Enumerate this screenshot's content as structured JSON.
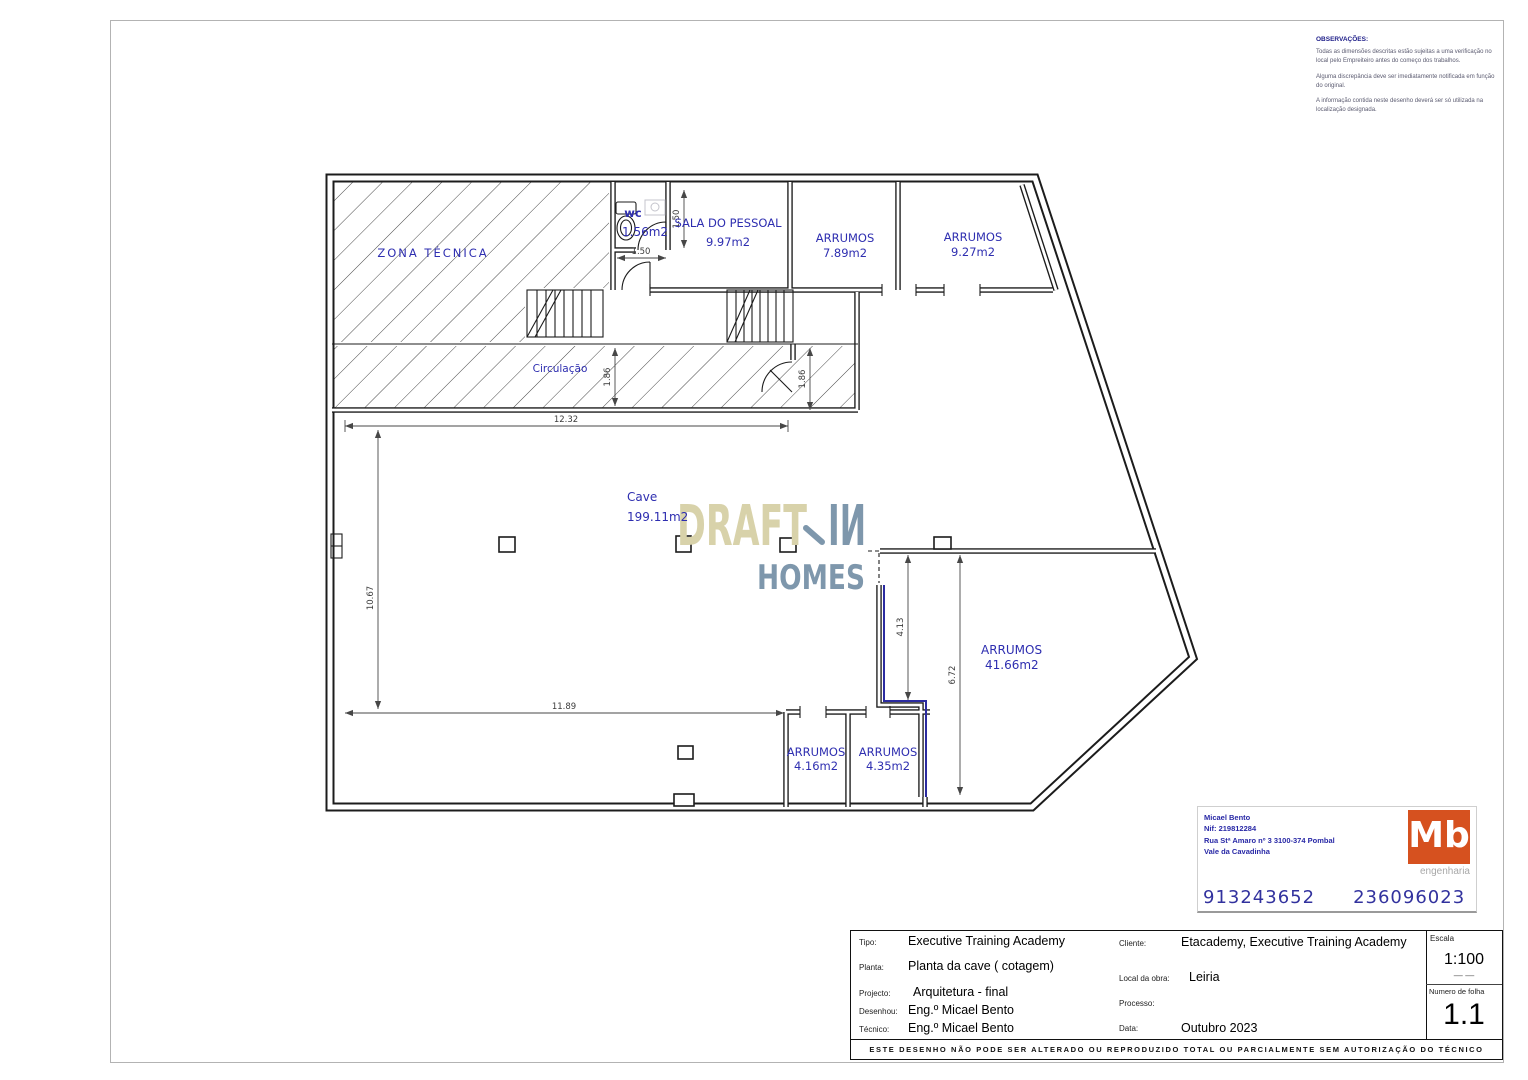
{
  "colors": {
    "label_blue": "#2e2eb0",
    "dim_gray": "#3c3c3c",
    "watermark_tan": "#d8d2aa",
    "watermark_slate": "#7e97ac",
    "logo_orange": "#d6511f",
    "stamp_blue": "#2828a6"
  },
  "observations": {
    "title": "OBSERVAÇÕES:",
    "p1": "Todas as dimensões descritas estão sujeitas a uma verificação no local pelo Empreiteiro antes do começo dos trabalhos.",
    "p2": "Alguma discrepância deve ser imediatamente notificada em função do original.",
    "p3": "A informação contida neste desenho deverá ser só utilizada na localização designada."
  },
  "plan": {
    "rooms": {
      "zona": {
        "label": "ZONA TÉCNICA"
      },
      "wc": {
        "label": "wc",
        "area": "1.56m2"
      },
      "sala": {
        "label": "SALA DO PESSOAL",
        "area": "9.97m2"
      },
      "arr1": {
        "label": "ARRUMOS",
        "area": "7.89m2"
      },
      "arr2": {
        "label": "ARRUMOS",
        "area": "9.27m2"
      },
      "circ": {
        "label": "Circulação"
      },
      "cave": {
        "label": "Cave",
        "area": "199.11m2"
      },
      "arr3": {
        "label": "ARRUMOS",
        "area": "41.66m2"
      },
      "arr4": {
        "label": "ARRUMOS",
        "area": "4.16m2"
      },
      "arr5": {
        "label": "ARRUMOS",
        "area": "4.35m2"
      }
    },
    "dims": {
      "wc_width": "1.50",
      "wc_height": "1.50",
      "corridor_left": "1.86",
      "corridor_right": "1.86",
      "top_width": "12.32",
      "left_height": "10.67",
      "bottom_width": "11.89",
      "storage_inner": "4.13",
      "storage_right": "6.72"
    },
    "watermark": {
      "word1": "DRAFT",
      "word2": "IИ",
      "word3": "HOMES"
    }
  },
  "stamp": {
    "name": "Micael Bento",
    "nif": "Nif: 219812284",
    "address1": "Rua Stª Amaro nº 3 3100-374 Pombal",
    "address2": "Vale da Cavadinha",
    "phone1": "913243652",
    "phone2": "236096023",
    "logo_text": "Mb",
    "logo_sub": "engenharia"
  },
  "titleblock": {
    "tipo_label": "Tipo:",
    "tipo": "Executive Training Academy",
    "planta_label": "Planta:",
    "planta": "Planta da cave ( cotagem)",
    "projecto_label": "Projecto:",
    "projecto": "Arquitetura - final",
    "desenhou_label": "Desenhou:",
    "desenhou": "Eng.º Micael Bento",
    "tecnico_label": "Técnico:",
    "tecnico": "Eng.º Micael Bento",
    "cliente_label": "Cliente:",
    "cliente": "Etacademy, Executive Training Academy",
    "local_label": "Local da obra:",
    "local": "Leiria",
    "processo_label": "Processo:",
    "processo": "",
    "data_label": "Data:",
    "data": "Outubro  2023",
    "escala_label": "Escala",
    "escala": "1:100",
    "escala_sub": "— —",
    "folha_label": "Numero de folha",
    "folha": "1.1",
    "disclaimer": "ESTE DESENHO NÃO PODE SER ALTERADO OU REPRODUZIDO TOTAL OU PARCIALMENTE SEM AUTORIZAÇÃO DO TÉCNICO"
  }
}
